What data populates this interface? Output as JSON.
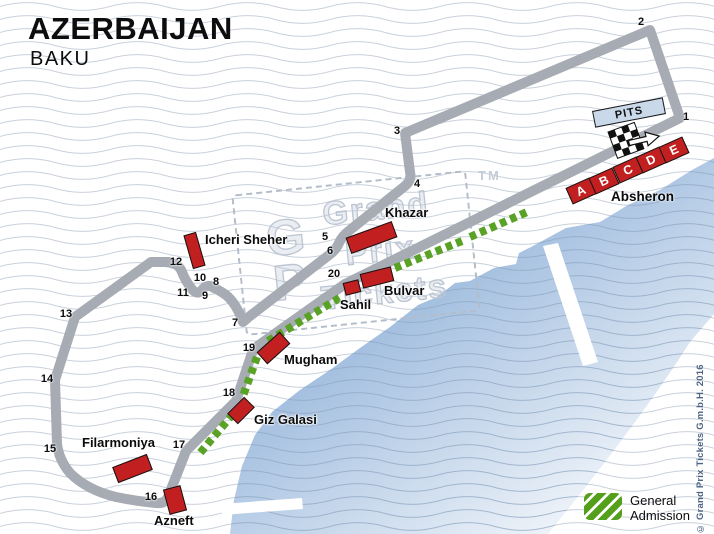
{
  "header": {
    "title": "AZERBAIJAN",
    "subtitle": "BAKU"
  },
  "watermark": {
    "letter_top": "G",
    "letter_bottom": "P",
    "word1": "Grand",
    "word2": "Prix",
    "word3": "Tickets",
    "tm": "TM"
  },
  "pits": {
    "label": "PITS"
  },
  "legend": {
    "line1": "General",
    "line2": "Admission"
  },
  "copyright": "© Grand Prix Tickets G.m.b.H. 2016",
  "colors": {
    "track_gray": "#a7acb4",
    "grandstand_red": "#c22020",
    "general_admission_green": "#5aa226",
    "water_blue": "#a3bfdf",
    "pits_fill": "#c9d9ea",
    "watermark_gray": "#bcc5d2",
    "copyright_blue": "#4d6483"
  },
  "turns": [
    {
      "n": "1",
      "x": 686,
      "y": 117
    },
    {
      "n": "2",
      "x": 641,
      "y": 22
    },
    {
      "n": "3",
      "x": 397,
      "y": 131
    },
    {
      "n": "4",
      "x": 417,
      "y": 184
    },
    {
      "n": "5",
      "x": 325,
      "y": 237
    },
    {
      "n": "6",
      "x": 330,
      "y": 251
    },
    {
      "n": "7",
      "x": 235,
      "y": 323
    },
    {
      "n": "8",
      "x": 216,
      "y": 282
    },
    {
      "n": "9",
      "x": 205,
      "y": 296
    },
    {
      "n": "10",
      "x": 200,
      "y": 278
    },
    {
      "n": "11",
      "x": 183,
      "y": 293
    },
    {
      "n": "12",
      "x": 176,
      "y": 262
    },
    {
      "n": "13",
      "x": 66,
      "y": 314
    },
    {
      "n": "14",
      "x": 47,
      "y": 379
    },
    {
      "n": "15",
      "x": 50,
      "y": 449
    },
    {
      "n": "16",
      "x": 151,
      "y": 497
    },
    {
      "n": "17",
      "x": 179,
      "y": 445
    },
    {
      "n": "18",
      "x": 229,
      "y": 393
    },
    {
      "n": "19",
      "x": 249,
      "y": 348
    },
    {
      "n": "20",
      "x": 334,
      "y": 274
    }
  ],
  "grandstands": [
    {
      "id": "icheri-sheher",
      "label": "Icheri Sheher",
      "cx": 194,
      "cy": 250,
      "w": 13,
      "h": 35,
      "angle": -16,
      "lx": 205,
      "ly": 232
    },
    {
      "id": "khazar",
      "label": "Khazar",
      "cx": 371,
      "cy": 237,
      "w": 49,
      "h": 17,
      "angle": -20,
      "lx": 385,
      "ly": 205
    },
    {
      "id": "bulvar",
      "label": "Bulvar",
      "cx": 377,
      "cy": 277,
      "w": 32,
      "h": 15,
      "angle": -14,
      "lx": 384,
      "ly": 283
    },
    {
      "id": "sahil",
      "label": "Sahil",
      "cx": 352,
      "cy": 287,
      "w": 16,
      "h": 13,
      "angle": -14,
      "lx": 340,
      "ly": 297
    },
    {
      "id": "mugham",
      "label": "Mugham",
      "cx": 273,
      "cy": 348,
      "w": 31,
      "h": 16,
      "angle": -42,
      "lx": 284,
      "ly": 352
    },
    {
      "id": "giz-galasi",
      "label": "Giz Galasi",
      "cx": 241,
      "cy": 410,
      "w": 24,
      "h": 15,
      "angle": -45,
      "lx": 254,
      "ly": 412
    },
    {
      "id": "filarmoniya",
      "label": "Filarmoniya",
      "cx": 132,
      "cy": 468,
      "w": 37,
      "h": 17,
      "angle": -21,
      "lx": 82,
      "ly": 435
    },
    {
      "id": "azneft",
      "label": "Azneft",
      "cx": 175,
      "cy": 500,
      "w": 18,
      "h": 26,
      "angle": -15,
      "lx": 154,
      "ly": 513
    }
  ],
  "absheron": {
    "label": "Absheron",
    "w": 26,
    "h": 18,
    "angle": -24,
    "stands": [
      {
        "letter": "A",
        "cx": 581,
        "cy": 191
      },
      {
        "letter": "B",
        "cx": 604,
        "cy": 181
      },
      {
        "letter": "C",
        "cx": 628,
        "cy": 170
      },
      {
        "letter": "D",
        "cx": 651,
        "cy": 160
      },
      {
        "letter": "E",
        "cx": 674,
        "cy": 150
      }
    ]
  }
}
